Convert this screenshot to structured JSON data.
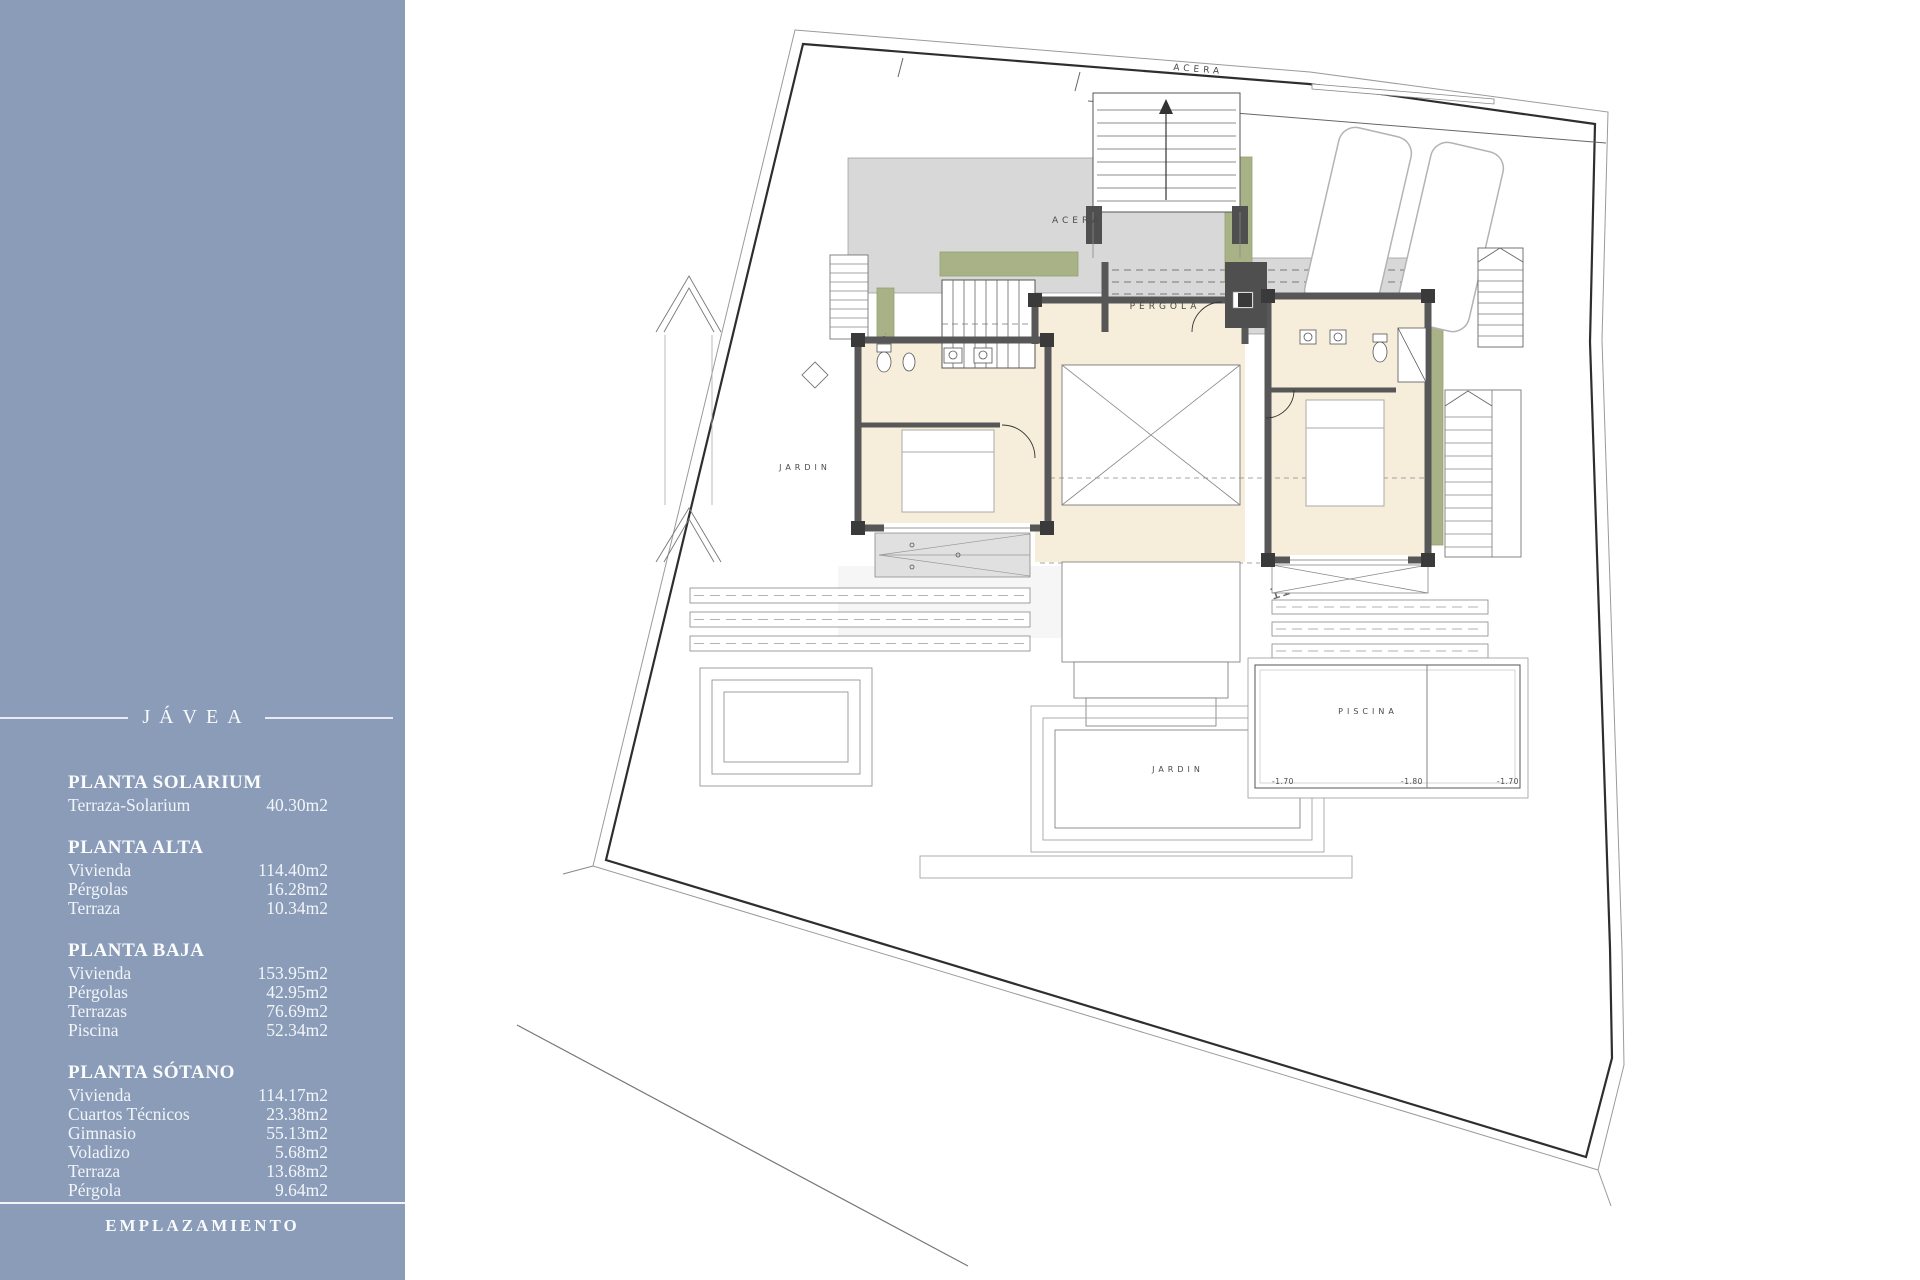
{
  "colors": {
    "sidebar_bg": "#8b9cb8",
    "sidebar_text": "#f6f8fa",
    "plan_wall": "#575757",
    "plan_room_fill": "#f6eedb",
    "plan_terrace_fill": "#d8d8d8",
    "plan_green": "#a9b287",
    "plan_line": "#333333"
  },
  "sidebar": {
    "title": "JÁVEA",
    "sections": [
      {
        "heading": "PLANTA SOLARIUM",
        "rows": [
          {
            "label": "Terraza-Solarium",
            "value": "40.30m2"
          }
        ]
      },
      {
        "heading": "PLANTA ALTA",
        "rows": [
          {
            "label": "Vivienda",
            "value": "114.40m2"
          },
          {
            "label": "Pérgolas",
            "value": "16.28m2"
          },
          {
            "label": "Terraza",
            "value": "10.34m2"
          }
        ]
      },
      {
        "heading": "PLANTA BAJA",
        "rows": [
          {
            "label": "Vivienda",
            "value": "153.95m2"
          },
          {
            "label": "Pérgolas",
            "value": "42.95m2"
          },
          {
            "label": "Terrazas",
            "value": "76.69m2"
          },
          {
            "label": "Piscina",
            "value": "52.34m2"
          }
        ]
      },
      {
        "heading": "PLANTA SÓTANO",
        "rows": [
          {
            "label": "Vivienda",
            "value": "114.17m2"
          },
          {
            "label": "Cuartos Técnicos",
            "value": "23.38m2"
          },
          {
            "label": "Gimnasio",
            "value": "55.13m2"
          },
          {
            "label": "Voladizo",
            "value": "5.68m2"
          },
          {
            "label": "Terraza",
            "value": "13.68m2"
          },
          {
            "label": "Pérgola",
            "value": "9.64m2"
          }
        ]
      }
    ],
    "footer": "EMPLAZAMIENTO"
  },
  "plan": {
    "labels": {
      "sidewalk_top": "ACERA",
      "sidewalk_terrace": "ACERA",
      "pergola": "PÉRGOLA",
      "garden_left": "JARDIN",
      "garden_strip": "JARD.",
      "garden_bottom": "JARDIN",
      "pool": "PISCINA",
      "pool_depth_left": "-1.70",
      "pool_depth_middle": "-1.80",
      "pool_depth_right": "-1.70",
      "survey_watermark": "117,55"
    }
  }
}
